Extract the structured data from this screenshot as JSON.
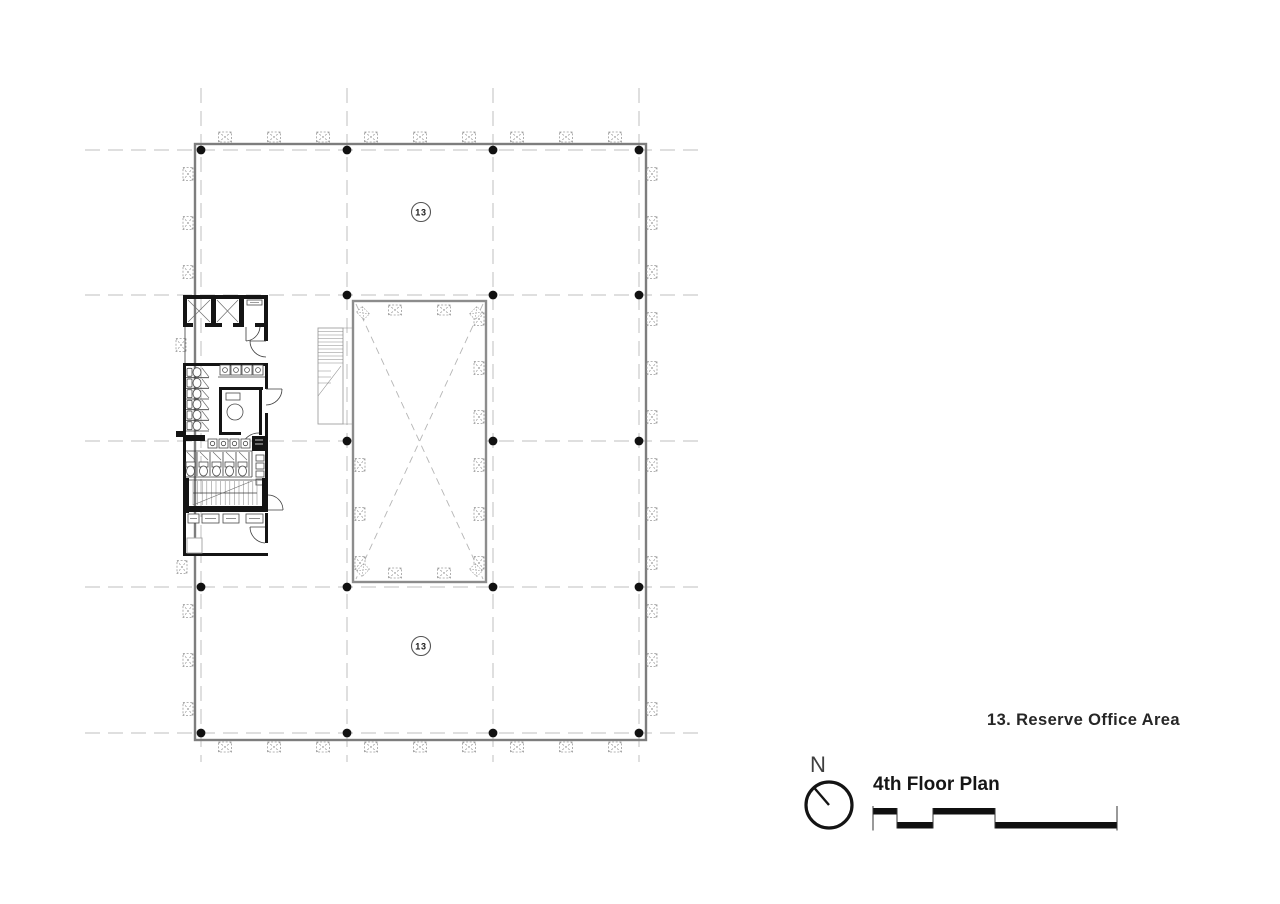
{
  "plan": {
    "area_label_top": "13",
    "area_label_bottom": "13"
  },
  "legend": {
    "entry": "13. Reserve Office Area"
  },
  "title_block": {
    "plan_title": "4th Floor Plan",
    "north_label": "N"
  },
  "colors": {
    "wall_gray": "#7d7d7d",
    "core_black": "#141414",
    "grid_gray": "#bfbfbf",
    "text_dark": "#1c1c1c"
  }
}
